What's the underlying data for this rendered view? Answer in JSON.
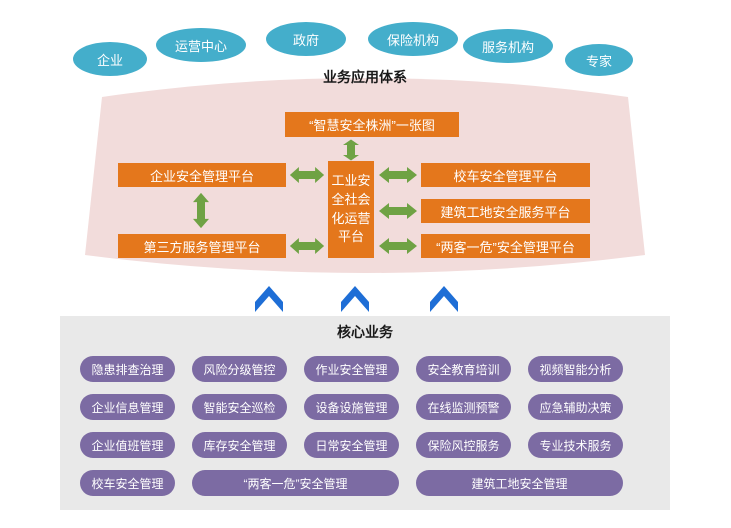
{
  "colors": {
    "stakeholder_teal": "#44AECB",
    "application_pink": "#F2DCDB",
    "platform_orange": "#E4771C",
    "arrow_green": "#6FA244",
    "arrow_blue": "#1E6ED6",
    "panel_gray": "#E9E9E9",
    "pill_purple": "#7C6BA3"
  },
  "stakeholders": [
    "企业",
    "运营中心",
    "政府",
    "保险机构",
    "服务机构",
    "专家"
  ],
  "application_system": {
    "title": "业务应用体系",
    "platforms": {
      "top": "“智慧安全株洲”一张图",
      "center": "工业安\n全社会\n化运营\n平台",
      "left1": "企业安全管理平台",
      "left2": "第三方服务管理平台",
      "right1": "校车安全管理平台",
      "right2": "建筑工地安全服务平台",
      "right3": "“两客一危”安全管理平台"
    }
  },
  "core_business": {
    "title": "核心业务",
    "rows": [
      [
        "隐患排查治理",
        "风险分级管控",
        "作业安全管理",
        "安全教育培训",
        "视频智能分析"
      ],
      [
        "企业信息管理",
        "智能安全巡检",
        "设备设施管理",
        "在线监测预警",
        "应急辅助决策"
      ],
      [
        "企业值班管理",
        "库存安全管理",
        "日常安全管理",
        "保险风控服务",
        "专业技术服务"
      ],
      [
        "校车安全管理",
        "“两客一危”安全管理",
        "建筑工地安全管理"
      ]
    ]
  }
}
